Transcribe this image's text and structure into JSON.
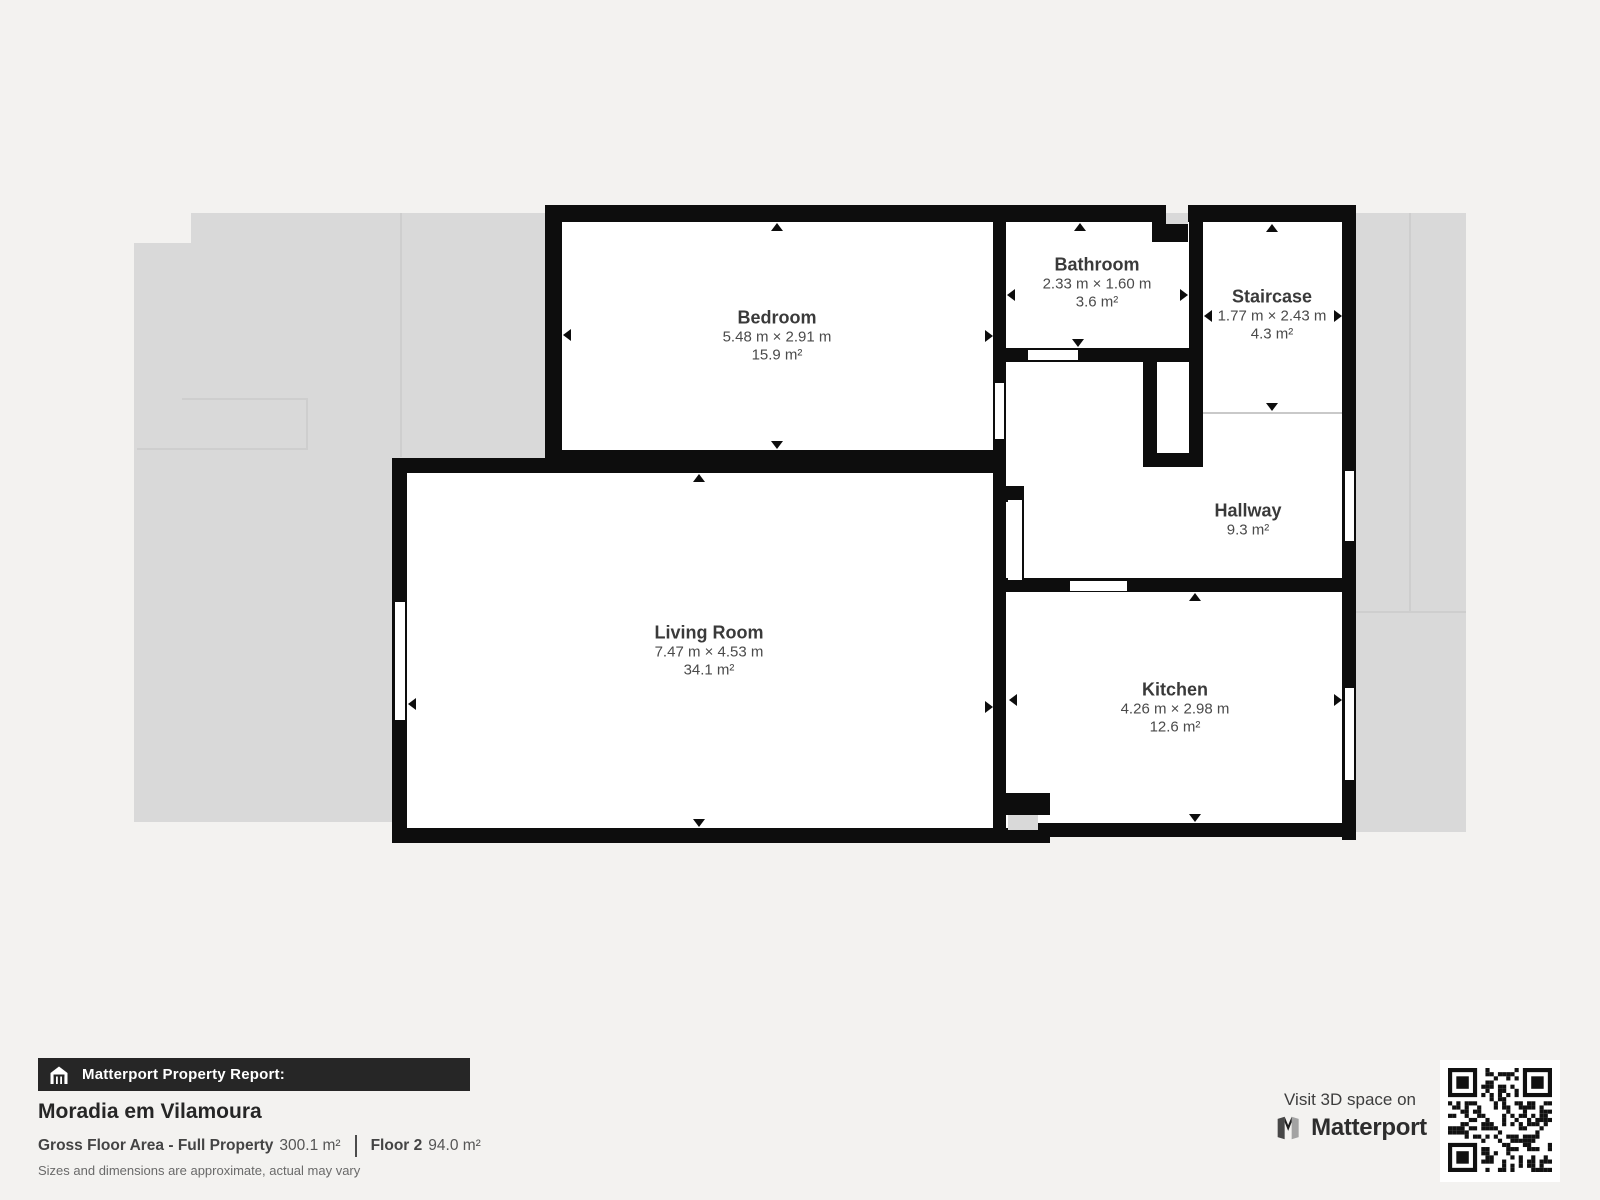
{
  "plan": {
    "rooms": [
      {
        "id": "bedroom",
        "name": "Bedroom",
        "dims": "5.48 m × 2.91 m",
        "area": "15.9 m²"
      },
      {
        "id": "bathroom",
        "name": "Bathroom",
        "dims": "2.33 m × 1.60 m",
        "area": "3.6 m²"
      },
      {
        "id": "staircase",
        "name": "Staircase",
        "dims": "1.77 m × 2.43 m",
        "area": "4.3 m²"
      },
      {
        "id": "hallway",
        "name": "Hallway",
        "dims": "",
        "area": "9.3 m²"
      },
      {
        "id": "living_room",
        "name": "Living Room",
        "dims": "7.47 m × 4.53 m",
        "area": "34.1 m²"
      },
      {
        "id": "kitchen",
        "name": "Kitchen",
        "dims": "4.26 m × 2.98 m",
        "area": "12.6 m²"
      }
    ]
  },
  "footer": {
    "report_label": "Matterport Property Report:",
    "property_name": "Moradia em Vilamoura",
    "gross_label": "Gross Floor Area - Full Property",
    "gross_value": "300.1 m²",
    "floor_label": "Floor 2",
    "floor_value": "94.0 m²",
    "disclaimer": "Sizes and dimensions are approximate, actual may vary",
    "visit_text": "Visit 3D space on",
    "brand": "Matterport"
  },
  "colors": {
    "wall": "#0d0d0d",
    "underlay": "#d9d9d9",
    "page_background": "#f3f2f0",
    "room_fill": "#ffffff"
  }
}
